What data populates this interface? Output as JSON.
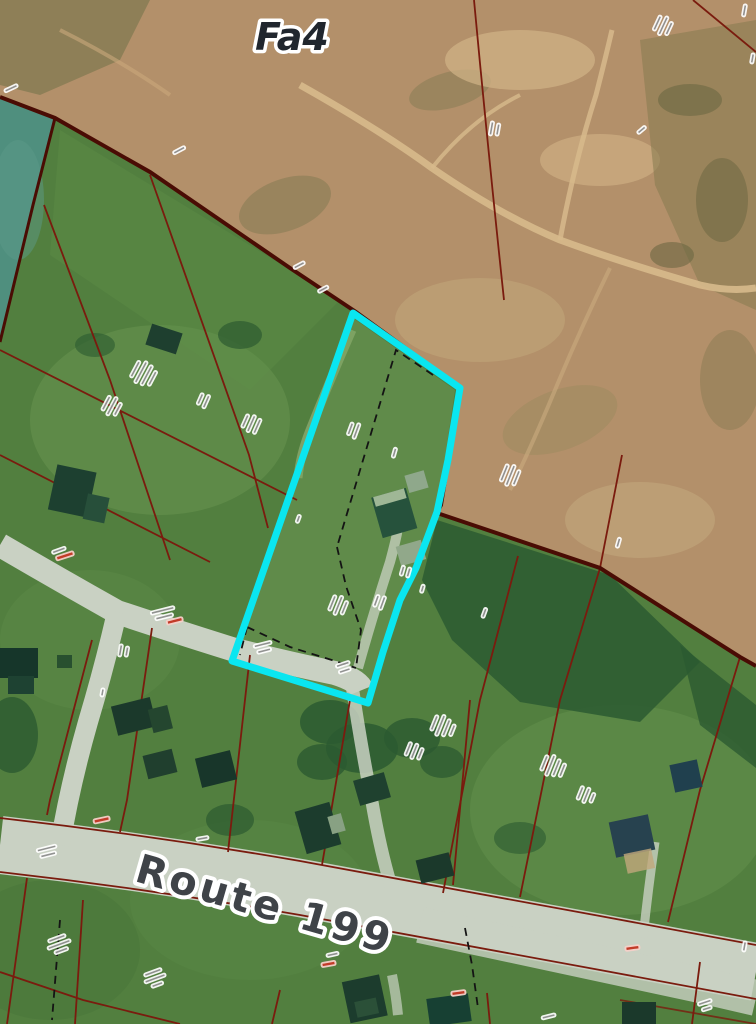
{
  "map": {
    "type": "aerial-cadastral-map",
    "zone_label": "Fa4",
    "road_label": "Route 199",
    "annotation_note": "numerous small rotated lot-number and area labels (illegible at this resolution)",
    "micro_labels": [
      {
        "x": 10,
        "y": 86,
        "rot": -25,
        "widths": [
          16
        ]
      },
      {
        "x": 178,
        "y": 148,
        "rot": -28,
        "widths": [
          15
        ]
      },
      {
        "x": 298,
        "y": 263,
        "rot": -28,
        "widths": [
          14
        ]
      },
      {
        "x": 322,
        "y": 287,
        "rot": -28,
        "widths": [
          13
        ]
      },
      {
        "x": 489,
        "y": 128,
        "rot": -80,
        "widths": [
          16,
          14
        ]
      },
      {
        "x": 655,
        "y": 22,
        "rot": -65,
        "widths": [
          18,
          22,
          16
        ]
      },
      {
        "x": 742,
        "y": 10,
        "rot": -80,
        "widths": [
          14
        ]
      },
      {
        "x": 750,
        "y": 58,
        "rot": -80,
        "widths": [
          12
        ]
      },
      {
        "x": 133,
        "y": 368,
        "rot": -62,
        "widths": [
          20,
          26,
          24,
          18
        ]
      },
      {
        "x": 104,
        "y": 402,
        "rot": -62,
        "widths": [
          18,
          22,
          16
        ]
      },
      {
        "x": 243,
        "y": 420,
        "rot": -66,
        "widths": [
          16,
          20,
          18
        ]
      },
      {
        "x": 198,
        "y": 398,
        "rot": -66,
        "widths": [
          14,
          16
        ]
      },
      {
        "x": 348,
        "y": 428,
        "rot": -70,
        "widths": [
          15,
          18
        ]
      },
      {
        "x": 392,
        "y": 452,
        "rot": -74,
        "widths": [
          12
        ]
      },
      {
        "x": 502,
        "y": 472,
        "rot": -68,
        "widths": [
          20,
          24,
          18
        ]
      },
      {
        "x": 330,
        "y": 602,
        "rot": -68,
        "widths": [
          18,
          22,
          16
        ]
      },
      {
        "x": 374,
        "y": 600,
        "rot": -70,
        "widths": [
          14,
          16
        ]
      },
      {
        "x": 400,
        "y": 570,
        "rot": -74,
        "widths": [
          12,
          12
        ]
      },
      {
        "x": 420,
        "y": 588,
        "rot": -74,
        "widths": [
          10
        ]
      },
      {
        "x": 342,
        "y": 662,
        "rot": -18,
        "widths": [
          16,
          14
        ]
      },
      {
        "x": 262,
        "y": 642,
        "rot": -14,
        "widths": [
          20,
          16
        ]
      },
      {
        "x": 162,
        "y": 608,
        "rot": -14,
        "widths": [
          26,
          20
        ]
      },
      {
        "x": 58,
        "y": 548,
        "rot": -20,
        "widths": [
          16
        ]
      },
      {
        "x": 118,
        "y": 650,
        "rot": -80,
        "widths": [
          14,
          12
        ]
      },
      {
        "x": 100,
        "y": 692,
        "rot": -80,
        "widths": [
          10
        ]
      },
      {
        "x": 432,
        "y": 722,
        "rot": -68,
        "widths": [
          18,
          24,
          20,
          14
        ]
      },
      {
        "x": 406,
        "y": 748,
        "rot": -68,
        "widths": [
          16,
          18,
          14
        ]
      },
      {
        "x": 542,
        "y": 762,
        "rot": -68,
        "widths": [
          18,
          24,
          20,
          16
        ]
      },
      {
        "x": 578,
        "y": 792,
        "rot": -68,
        "widths": [
          16,
          18,
          12
        ]
      },
      {
        "x": 482,
        "y": 612,
        "rot": -70,
        "widths": [
          12
        ]
      },
      {
        "x": 616,
        "y": 542,
        "rot": -74,
        "widths": [
          12
        ]
      },
      {
        "x": 46,
        "y": 846,
        "rot": -14,
        "widths": [
          22,
          18
        ]
      },
      {
        "x": 202,
        "y": 836,
        "rot": -10,
        "widths": [
          14
        ]
      },
      {
        "x": 332,
        "y": 952,
        "rot": -12,
        "widths": [
          14
        ]
      },
      {
        "x": 56,
        "y": 936,
        "rot": -20,
        "widths": [
          20,
          26,
          16
        ]
      },
      {
        "x": 152,
        "y": 970,
        "rot": -20,
        "widths": [
          20,
          24,
          14
        ]
      },
      {
        "x": 548,
        "y": 1014,
        "rot": -14,
        "widths": [
          16
        ]
      },
      {
        "x": 742,
        "y": 946,
        "rot": -80,
        "widths": [
          12
        ]
      },
      {
        "x": 704,
        "y": 1000,
        "rot": -18,
        "widths": [
          16,
          12
        ]
      },
      {
        "x": 640,
        "y": 128,
        "rot": -40,
        "widths": [
          12
        ]
      },
      {
        "x": 296,
        "y": 518,
        "rot": -70,
        "widths": [
          10
        ]
      }
    ],
    "red_labels": [
      {
        "x": 64,
        "y": 553,
        "rot": -18,
        "w": 20
      },
      {
        "x": 174,
        "y": 618,
        "rot": -14,
        "w": 18
      },
      {
        "x": 101,
        "y": 817,
        "rot": -12,
        "w": 18
      },
      {
        "x": 328,
        "y": 961,
        "rot": -10,
        "w": 16
      },
      {
        "x": 458,
        "y": 990,
        "rot": -8,
        "w": 16
      },
      {
        "x": 632,
        "y": 945,
        "rot": -8,
        "w": 16
      }
    ]
  },
  "colors": {
    "green_base": "#527f3f",
    "green_light": "#7ca45e",
    "green_dark": "#2c5a31",
    "sand": "#b3906a",
    "sand_light": "#d2b487",
    "sand_dark": "#7f7850",
    "teal_field": "#4f8f7e",
    "road": "#c9d1c3",
    "cadastral_line": "#7a1b0e",
    "boundary_line": "#4a0c04",
    "dashed_line": "#141414",
    "highlight": "#0ae6f0",
    "label_dark": "#20262e",
    "route_text": "#3f4348",
    "red_label_text": "#c23b28"
  }
}
